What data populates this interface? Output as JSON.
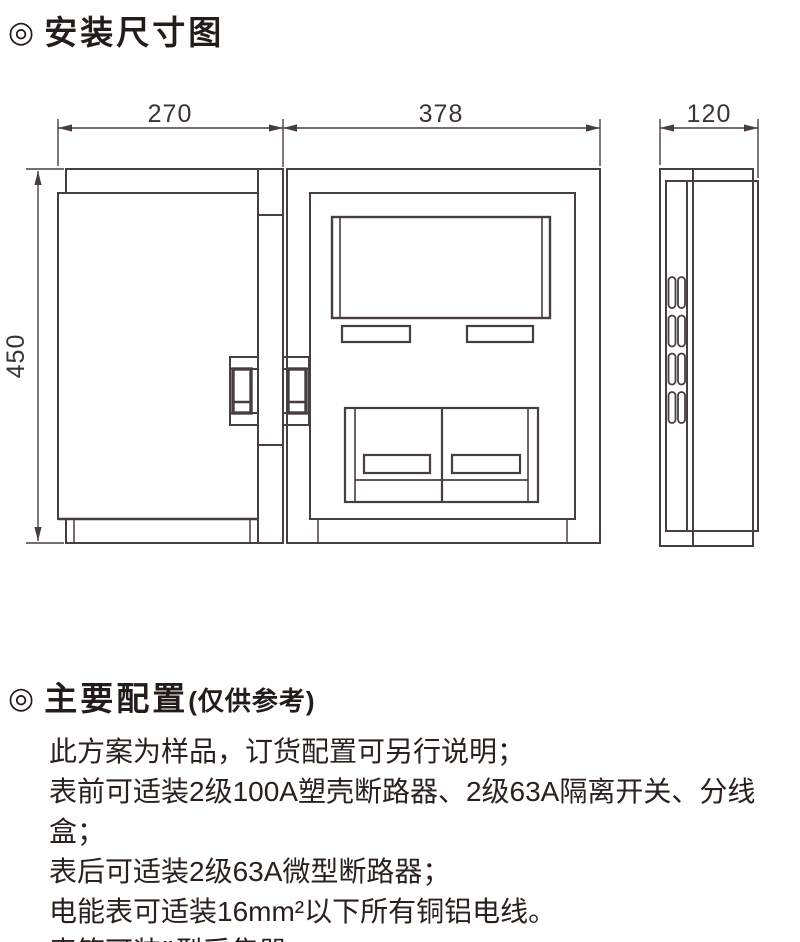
{
  "header": {
    "icon": "◎",
    "title": "安装尺寸图"
  },
  "diagram": {
    "dim_door_width": "270",
    "dim_box_width": "378",
    "dim_depth": "120",
    "dim_height": "450"
  },
  "config": {
    "icon": "◎",
    "title": "主要配置",
    "subtitle": "(仅供参考)",
    "lines": [
      "此方案为样品，订货配置可另行说明；",
      "表前可适装2级100A塑壳断路器、2级63A隔离开关、分线盒；",
      "表后可适装2级63A微型断路器；",
      "电能表可适装16mm²以下所有铜铝电线。",
      "表箱可装Ⅱ型采集器。"
    ]
  },
  "colors": {
    "line": "#473e3f",
    "text": "#241c1a"
  }
}
